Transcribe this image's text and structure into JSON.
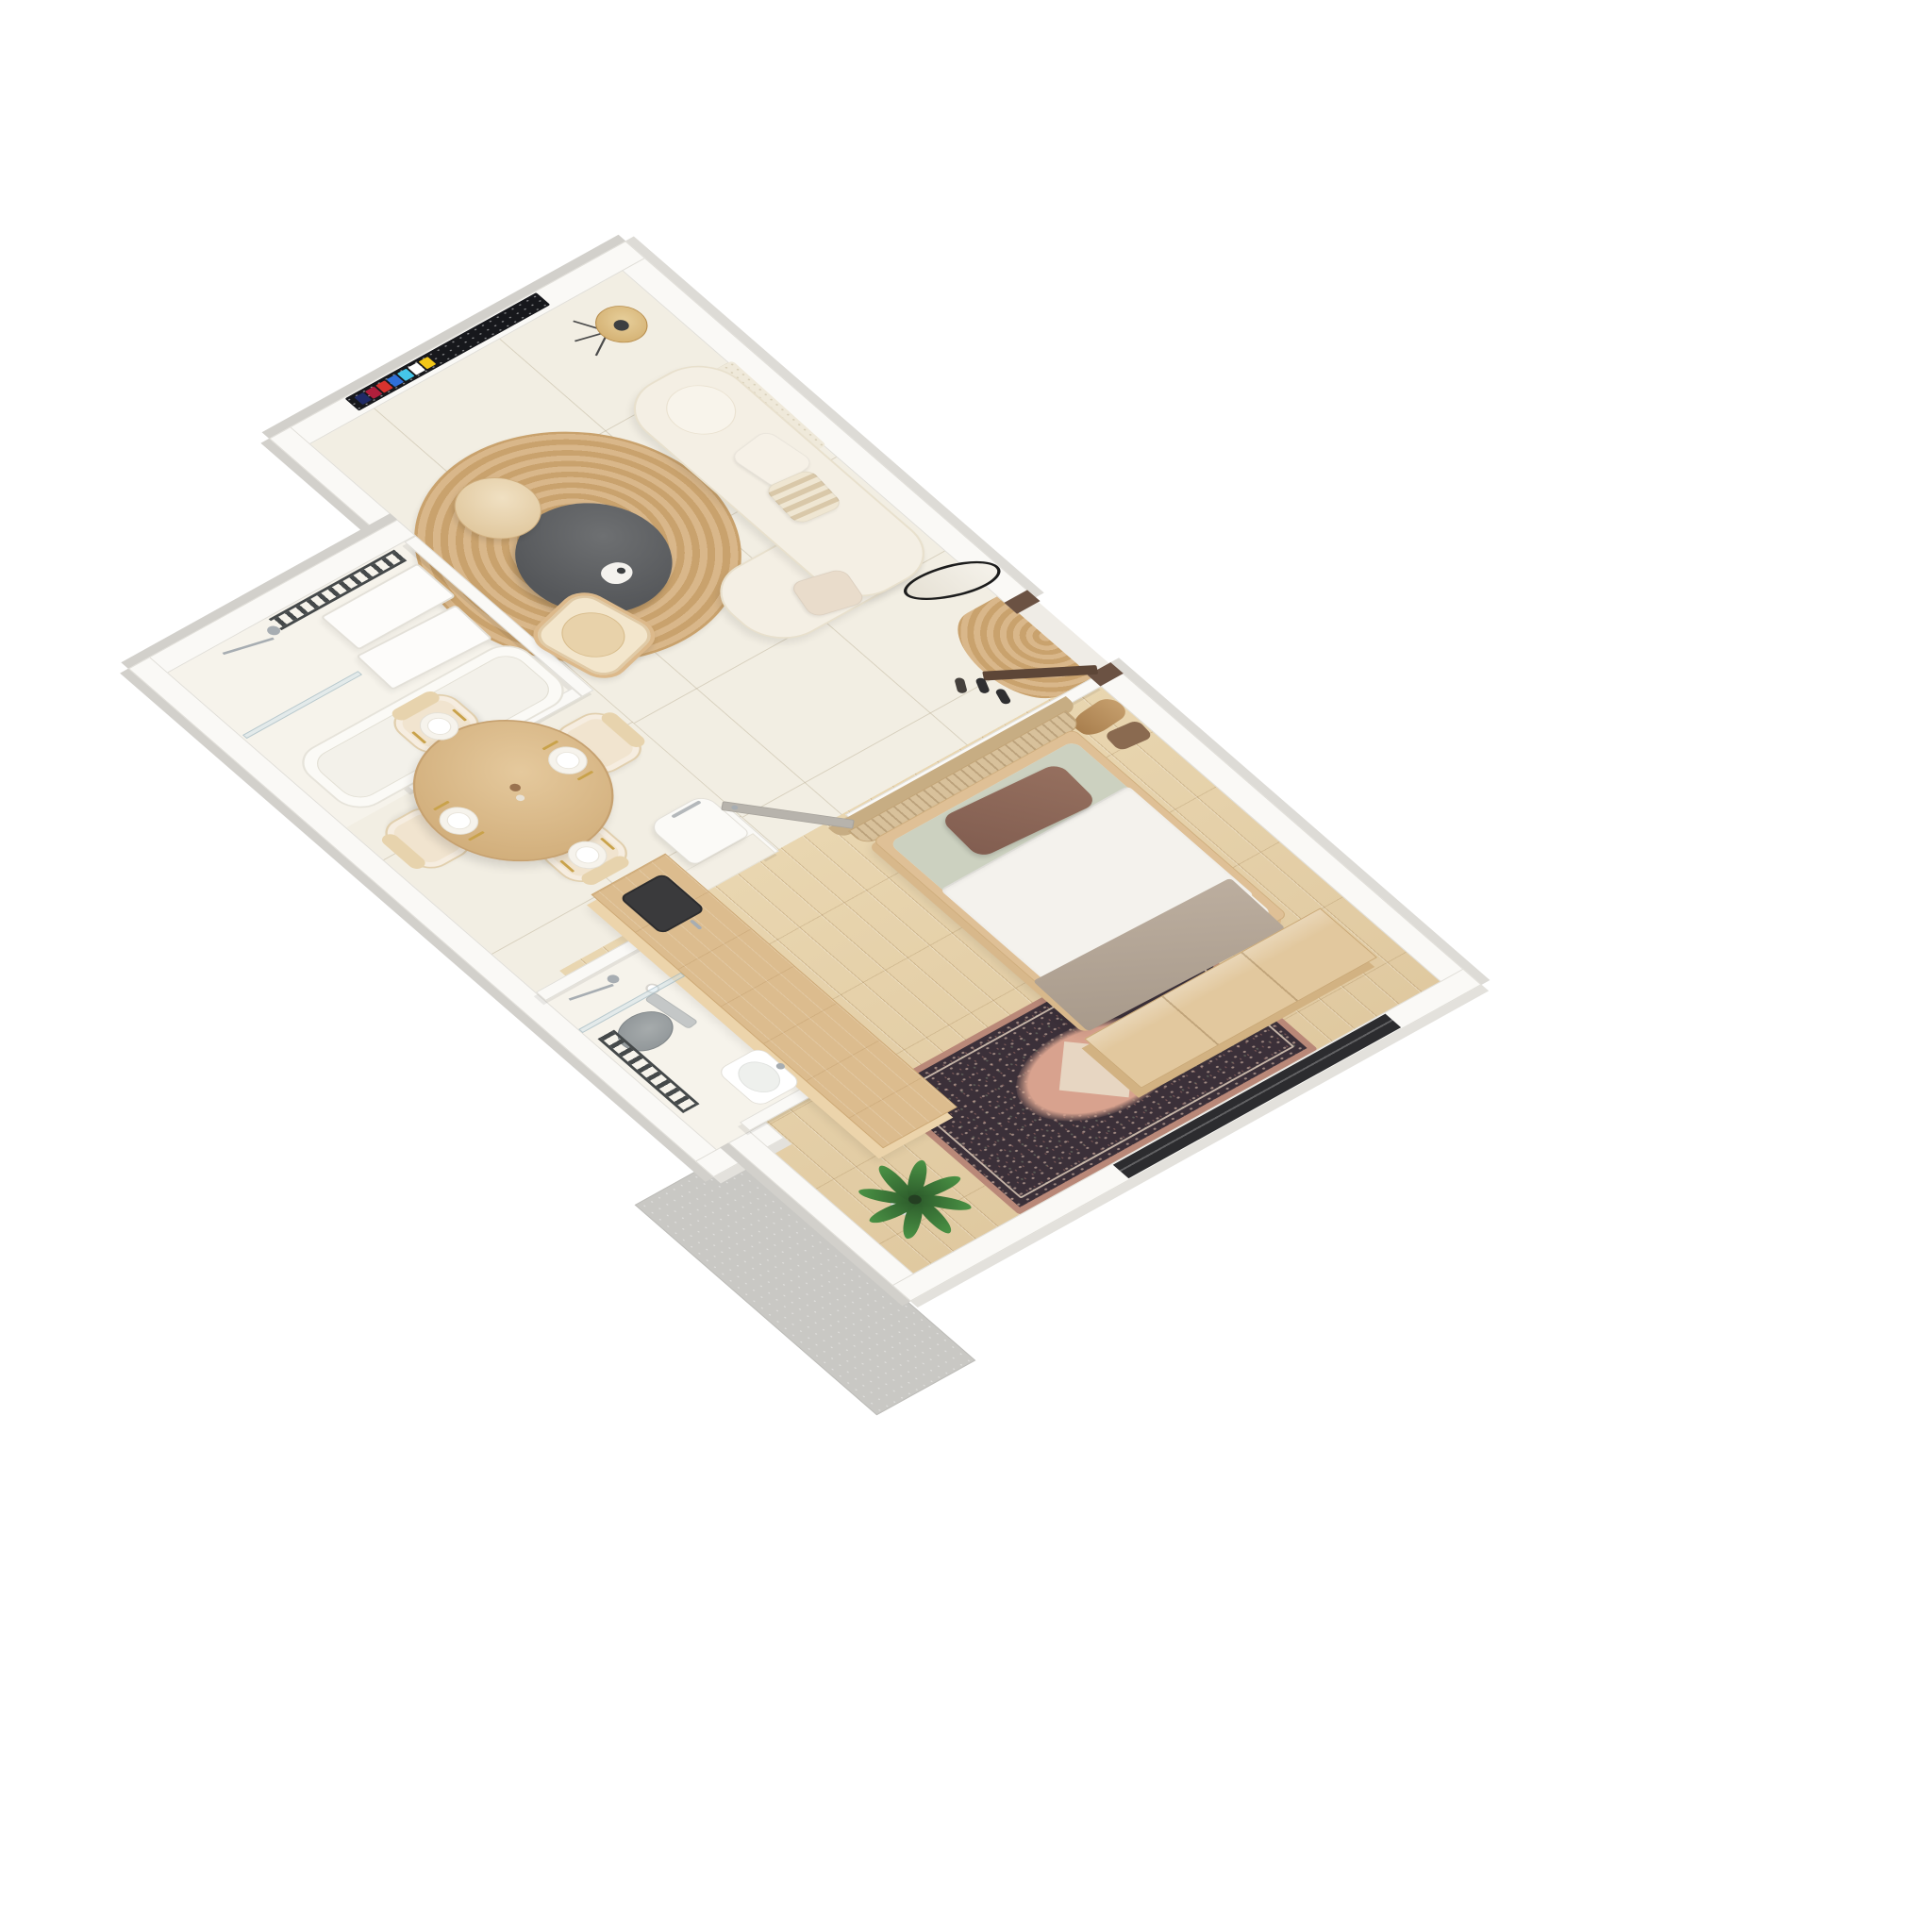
{
  "scene": {
    "title": "3D axonometric floor plan render of a one-bedroom apartment",
    "background": "#ffffff",
    "view": "top-down axonometric, rotated toward lower-right",
    "text_content": "none — image contains no readable text"
  },
  "palette": {
    "wall_top": "#faf9f6",
    "wall_edge": "#e0ded8",
    "wall_face": "#d2d0cb",
    "tile_floor": "#f2eee3",
    "tile_line": "rgba(188,177,152,0.5)",
    "bath_floor": "#f6f3eb",
    "wood_floor": "#e9d6b0",
    "wood_floor_dark": "#e0c9a0",
    "sofa_cream": "#f4efe4",
    "cushion_blush": "#e9dccb",
    "jute": "#c9a26d",
    "jute_light": "#d9b78a",
    "table_dark": "#55575a",
    "side_table_wood": "#dcc194",
    "rattan": "#dcb98b",
    "island_wood": "#dcbc8e",
    "island_side": "#ecd4ab",
    "counter_cream": "#f3efe5",
    "fridge_white": "#fbfaf7",
    "chrome": "#a7adb2",
    "radiator_dark": "#45494a",
    "glass": "rgba(203,224,232,0.45)",
    "toilet_gray": "#8b9194",
    "door_brown": "#6b5243",
    "door_gray": "#b7b3ac",
    "window_dark": "#2c2c2f",
    "terrace_gray": "#c9c8c4",
    "bed_wood": "#dfc096",
    "mattress_white": "#f2f0ea",
    "pillow_brown": "#815d50",
    "bed_sage": "#ccd1c0",
    "throw_taupe": "#a89a8b",
    "headboard_rattan": "#d8c19b",
    "rug_dark": "#3b3039",
    "rug_rose": "#d8a28e",
    "rug_cream": "#e9dcc8",
    "plant_green": "#4a9245",
    "plant_dark": "#2c5a2a",
    "pot_white": "#dcdcd8",
    "tv_dark": "#17181c",
    "gold": "#c9a24a",
    "plate_white": "#ffffff",
    "wardrobe_wood": "#e2c89e",
    "wardrobe_side": "#d2b282"
  },
  "tv": {
    "app_tile_colors": [
      "#f2c718",
      "#ffffff",
      "#45c6ea",
      "#2f6fd8",
      "#d8332e",
      "#b01f3c",
      "#1f2a66"
    ]
  },
  "rooms": {
    "living": {
      "label": "Living room"
    },
    "hall": {
      "label": "Entrance hall"
    },
    "bedroom": {
      "label": "Bedroom"
    },
    "shower_room": {
      "label": "Shower room"
    },
    "dining": {
      "label": "Dining area"
    },
    "kitchen": {
      "label": "Kitchen"
    },
    "bathroom": {
      "label": "Bathroom"
    },
    "terrace": {
      "label": "Terrace slab"
    }
  },
  "labels": {
    "tv": "Wall-mounted TV showing smart-TV launcher",
    "floor_lamp": "Tripod floor lamp with rattan shade",
    "wall_hanging": "Textured cream wall hanging",
    "sofa": "Cream curved sofa",
    "sofa_chaise": "Sofa chaise end",
    "bolster": "Round bolster cushion",
    "pillow": "Throw pillow",
    "jute_rug": "Round jute rug",
    "coffee_table": "Dark round coffee table with vase",
    "side_table": "Round wooden side table",
    "armchair": "Rattan armchair with cushion",
    "mirror": "Organic oval mirror, black frame",
    "entrance_door": "Entrance door, dark wood, open",
    "door_mat": "Half-round jute doormat",
    "shoes": "Shoes by the door",
    "coats": "Coats and bag on wall hooks",
    "towel_radiator": "Dark heated towel rail",
    "shower": "Chrome shower set",
    "glass_screen": "Glass shower screen",
    "bathtub": "Bathtub",
    "vanity": "White bathroom cabinet panels",
    "dining_table": "Round wooden dining table",
    "dining_chair": "Upholstered cream dining chair",
    "place_setting": "Place setting with gold cutlery",
    "centerpiece": "Table centerpiece",
    "fridge": "White retro fridge",
    "kitchen_counter": "Cream kitchen counter",
    "kitchen_island": "Wooden kitchen island",
    "kitchen_sink": "Dark inset sink with faucet",
    "washbasin": "White washbasin",
    "toilet": "Gray wall-hung toilet",
    "toilet_paper": "Toilet paper holder",
    "bed": "Double bed with wooden frame",
    "headboard": "Curved rattan headboard",
    "bed_pillow": "Brown pillow",
    "duvet": "White duvet",
    "throw": "Taupe end-of-bed throw",
    "wardrobe": "Wooden wardrobe at bed foot",
    "area_rug": "Persian-style area rug",
    "plant": "Potted fan palm",
    "window": "Dark floor-to-ceiling window",
    "bedroom_door": "Gray bedroom door, open",
    "terrace": "Concrete terrace slab"
  },
  "counts": {
    "dining_chairs": 4,
    "dining_place_settings": 4,
    "tv_app_tiles": 7
  }
}
